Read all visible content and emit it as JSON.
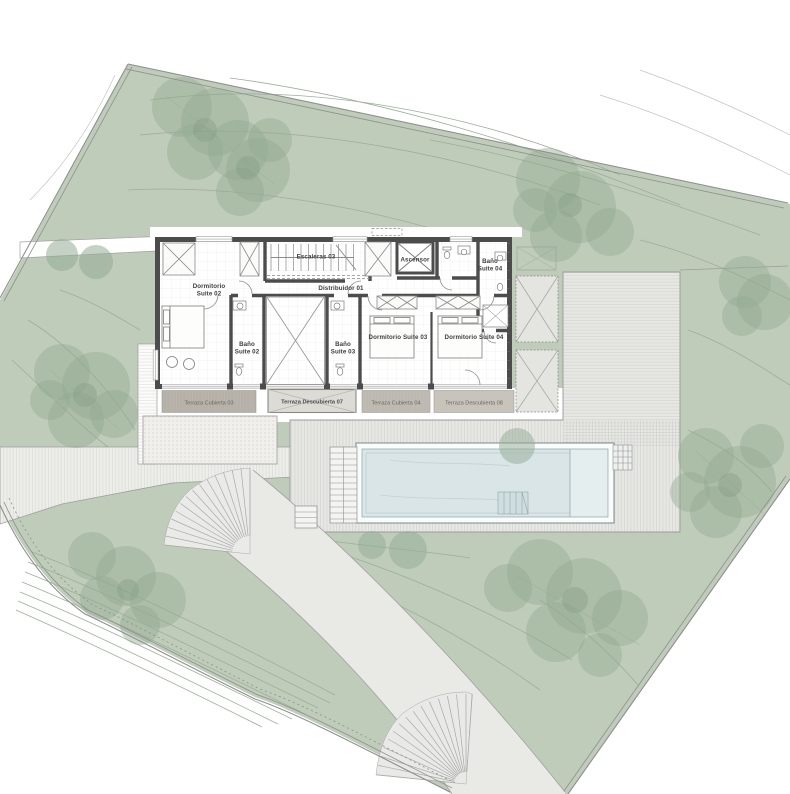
{
  "colors": {
    "site_green": "#bfccba",
    "tree_foliage": "#94ab93",
    "tree_dark": "#7d997d",
    "contour_line": "#9cae9a",
    "contour_line_gray": "#c4c4c4",
    "wall_dark": "#4c4c4c",
    "pool_water": "#d9e5e6",
    "pool_spa": "#e4eeee",
    "deck_gray": "#e7e7e4",
    "ramp_gray": "#e9e9e6",
    "walkway_gray": "#ededea",
    "courtyard_gravel": "#f0efeb",
    "terrace_cubierta_03": "#b5b0a8",
    "terrace_descubierta_07": "#dddbd6",
    "terrace_cubierta_04": "#bdb9b1",
    "terrace_descubierta_08": "#c7c3bb",
    "boundary_line": "#8f8f8f"
  },
  "rooms": {
    "escaleras": "Escaleras 03",
    "distribuidor": "Distribuidor 01",
    "ascensor": "Ascensor",
    "dormitorio_suite_02_line1": "Dormitorio",
    "dormitorio_suite_02_line2": "Suite 02",
    "bano_suite_02_line1": "Baño",
    "bano_suite_02_line2": "Suite 02",
    "bano_suite_03_line1": "Baño",
    "bano_suite_03_line2": "Suite 03",
    "bano_suite_04_line1": "Baño",
    "bano_suite_04_line2": "Suite 04",
    "dormitorio_suite_03": "Dormitorio Suite 03",
    "dormitorio_suite_04": "Dormitorio Suite 04"
  },
  "terraces": {
    "cubierta_03": "Terraza Cubierta 03",
    "descubierta_07": "Terraza Descubierta 07",
    "cubierta_04": "Terraza Cubierta 04",
    "descubierta_08": "Terraza Descubierta 08"
  }
}
